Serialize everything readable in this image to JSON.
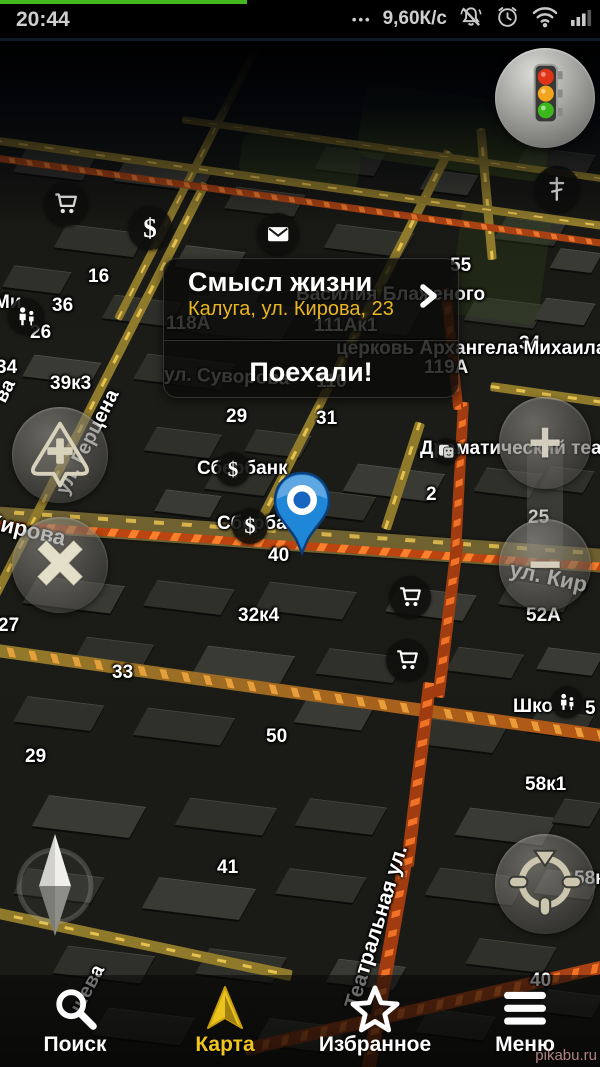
{
  "status_bar": {
    "time": "20:44",
    "dots": "•••",
    "net_speed": "9,60К/с",
    "icon_names": [
      "muted-bell-icon",
      "alarm-clock-icon",
      "wifi-icon",
      "signal-bars-icon"
    ]
  },
  "route_card": {
    "title": "Смысл жизни",
    "subtitle": "Калуга, ул. Кирова, 23",
    "action_label": "Поехали!"
  },
  "controls": {
    "zoom_in_glyph": "+",
    "zoom_out_glyph": "−"
  },
  "tab_bar": {
    "active_color": "#eec41e",
    "items": [
      {
        "id": "search",
        "label": "Поиск",
        "icon": "search-icon",
        "active": false
      },
      {
        "id": "map",
        "label": "Карта",
        "icon": "navigation-arrow-icon",
        "active": true
      },
      {
        "id": "favorites",
        "label": "Избранное",
        "icon": "star-icon",
        "active": false
      },
      {
        "id": "menu",
        "label": "Меню",
        "icon": "menu-icon",
        "active": false
      }
    ]
  },
  "watermark": "pikabu.ru",
  "map": {
    "colors": {
      "background": "#1a1a17",
      "building": "#30302b",
      "road_yellow": "#8f7a2c",
      "road_traffic": "#bc4410",
      "pin_blue": "#2086d8",
      "accent_yellow": "#e9b61f"
    },
    "labels": [
      {
        "text": "16",
        "x": 88,
        "y": 266
      },
      {
        "text": "36",
        "x": 52,
        "y": 295
      },
      {
        "text": "26",
        "x": 30,
        "y": 322
      },
      {
        "text": "Ми",
        "x": -6,
        "y": 292
      },
      {
        "text": "34",
        "x": -4,
        "y": 357
      },
      {
        "text": "39к3",
        "x": 50,
        "y": 373
      },
      {
        "text": "29",
        "x": 226,
        "y": 406
      },
      {
        "text": "31",
        "x": 316,
        "y": 408
      },
      {
        "text": "Драматический театр",
        "x": 420,
        "y": 438
      },
      {
        "text": "2",
        "x": 426,
        "y": 484
      },
      {
        "text": "Сбербанк",
        "x": 197,
        "y": 458
      },
      {
        "text": "Сбербанк",
        "x": 217,
        "y": 513
      },
      {
        "text": "40",
        "x": 268,
        "y": 545
      },
      {
        "text": "25",
        "x": 528,
        "y": 507
      },
      {
        "text": "ул. Кир",
        "x": 510,
        "y": 556,
        "rot": 12,
        "size": 22
      },
      {
        "text": "Кирова",
        "x": -12,
        "y": 508,
        "rot": 13,
        "size": 22
      },
      {
        "text": "ва",
        "x": 0,
        "y": 390,
        "rot": -63,
        "size": 20
      },
      {
        "text": "ул. Герцена",
        "x": 62,
        "y": 482,
        "rot": -63,
        "size": 20
      },
      {
        "text": "Театральная ул.",
        "x": 352,
        "y": 996,
        "rot": -73,
        "size": 21
      },
      {
        "text": "шева",
        "x": 76,
        "y": 1000,
        "rot": -62,
        "size": 20
      },
      {
        "text": "52А",
        "x": 526,
        "y": 605
      },
      {
        "text": "32к4",
        "x": 238,
        "y": 605
      },
      {
        "text": "33",
        "x": 112,
        "y": 662
      },
      {
        "text": "27",
        "x": -2,
        "y": 615
      },
      {
        "text": "Шко",
        "x": 513,
        "y": 696
      },
      {
        "text": "5",
        "x": 585,
        "y": 698
      },
      {
        "text": "58к1",
        "x": 525,
        "y": 774
      },
      {
        "text": "29",
        "x": 25,
        "y": 746
      },
      {
        "text": "50",
        "x": 266,
        "y": 726
      },
      {
        "text": "41",
        "x": 217,
        "y": 857
      },
      {
        "text": "58к",
        "x": 574,
        "y": 868
      },
      {
        "text": "40",
        "x": 530,
        "y": 970
      },
      {
        "text": "34",
        "x": 519,
        "y": 333
      },
      {
        "text": "церковь Архангела Михаила",
        "x": 336,
        "y": 338
      },
      {
        "text": "119А",
        "x": 424,
        "y": 357
      },
      {
        "text": "111Ак1",
        "x": 314,
        "y": 315
      },
      {
        "text": "110",
        "x": 316,
        "y": 371
      },
      {
        "text": "118А",
        "x": 166,
        "y": 313
      },
      {
        "text": "ул. Суворова",
        "x": 164,
        "y": 364,
        "rot": 2
      },
      {
        "text": "Василия Блаженого",
        "x": 296,
        "y": 284
      },
      {
        "text": "55",
        "x": 450,
        "y": 255
      }
    ],
    "pois": [
      {
        "type": "shopping-cart",
        "x": 44,
        "y": 182,
        "d": 44
      },
      {
        "type": "currency",
        "glyph": "$",
        "x": 128,
        "y": 206,
        "d": 44
      },
      {
        "type": "mail",
        "x": 257,
        "y": 213,
        "d": 42
      },
      {
        "type": "family",
        "x": 8,
        "y": 298,
        "d": 36
      },
      {
        "type": "currency",
        "glyph": "$",
        "x": 216,
        "y": 452,
        "d": 34
      },
      {
        "type": "currency",
        "glyph": "$",
        "x": 232,
        "y": 508,
        "d": 36
      },
      {
        "type": "shopping-cart",
        "x": 389,
        "y": 576,
        "d": 42
      },
      {
        "type": "shopping-cart",
        "x": 386,
        "y": 639,
        "d": 42
      },
      {
        "type": "family",
        "x": 551,
        "y": 686,
        "d": 32
      },
      {
        "type": "theater",
        "x": 433,
        "y": 438,
        "d": 26
      },
      {
        "type": "church-cross",
        "x": 534,
        "y": 166,
        "d": 46
      }
    ]
  }
}
